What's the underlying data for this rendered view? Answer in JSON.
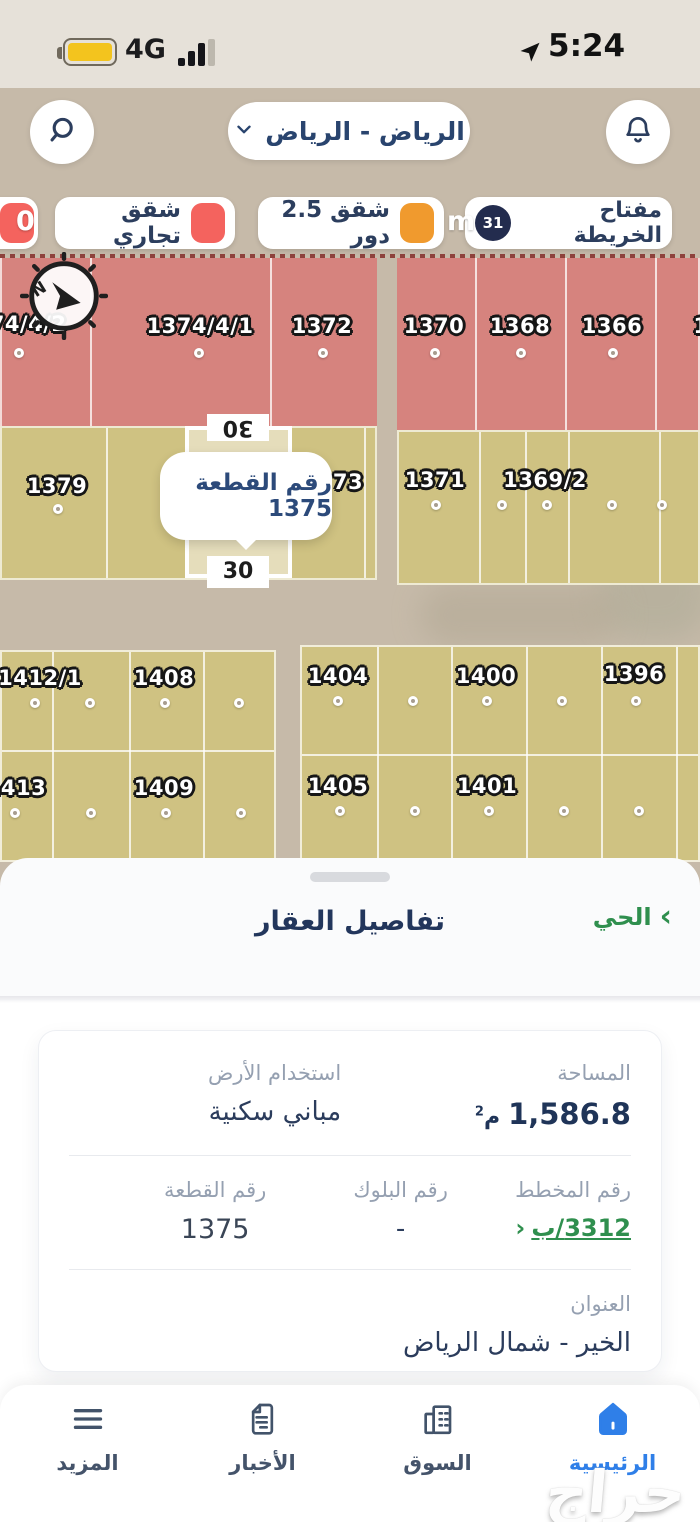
{
  "status_bar": {
    "network": "4G",
    "time": "5:24"
  },
  "header": {
    "region": "الرياض - الرياض"
  },
  "legend": {
    "key_chip": {
      "label": "مفتاح الخريطة",
      "count": "31"
    },
    "chips": [
      {
        "label": "شقق 2.5 دور",
        "color": "#f09a2e"
      },
      {
        "label": "شقق تجاري",
        "color": "#f4635e"
      }
    ],
    "fragment_zero": "0",
    "scale_m": "m"
  },
  "map": {
    "compass": "N",
    "tooltip": "رقم القطعة 1375",
    "selected_dim_top": "30",
    "selected_dim_bottom": "30",
    "parcels": [
      "1374/4/2",
      "1374/4/1",
      "1372",
      "1370",
      "1368",
      "1366",
      "1379",
      "73",
      "1371",
      "1369/2",
      "1412/1",
      "1408",
      "1404",
      "1400",
      "1396",
      "1413",
      "1409",
      "1405",
      "1401",
      "1"
    ]
  },
  "sheet": {
    "title": "تفاصيل العقار",
    "district_link": "الحي",
    "chevron": "›"
  },
  "details": {
    "area_label": "المساحة",
    "area_value": "1,586.8",
    "area_unit_letter": "م",
    "area_unit_sup": "2",
    "land_use_label": "استخدام الأرض",
    "land_use_value": "مباني سكنية",
    "plan_label": "رقم المخطط",
    "plan_value": "3312/ب",
    "plan_chevron": "‹",
    "block_label": "رقم البلوك",
    "block_value": "-",
    "parcel_label": "رقم القطعة",
    "parcel_value": "1375",
    "address_label": "العنوان",
    "address_value": "الخير - شمال الرياض"
  },
  "nav": {
    "items": [
      {
        "label": "الرئيسية",
        "active": true
      },
      {
        "label": "السوق",
        "active": false
      },
      {
        "label": "الأخبار",
        "active": false
      },
      {
        "label": "المزيد",
        "active": false
      }
    ]
  },
  "watermark": "حراج",
  "colors": {
    "accent_green": "#2f8f4e",
    "active_blue": "#2f7fe8",
    "parcel_red": "#d6837e",
    "parcel_tan": "#cfc282",
    "legend_red": "#f4635e",
    "legend_orange": "#f09a2e",
    "badge_navy": "#232c4e",
    "text_navy": "#22365c"
  }
}
